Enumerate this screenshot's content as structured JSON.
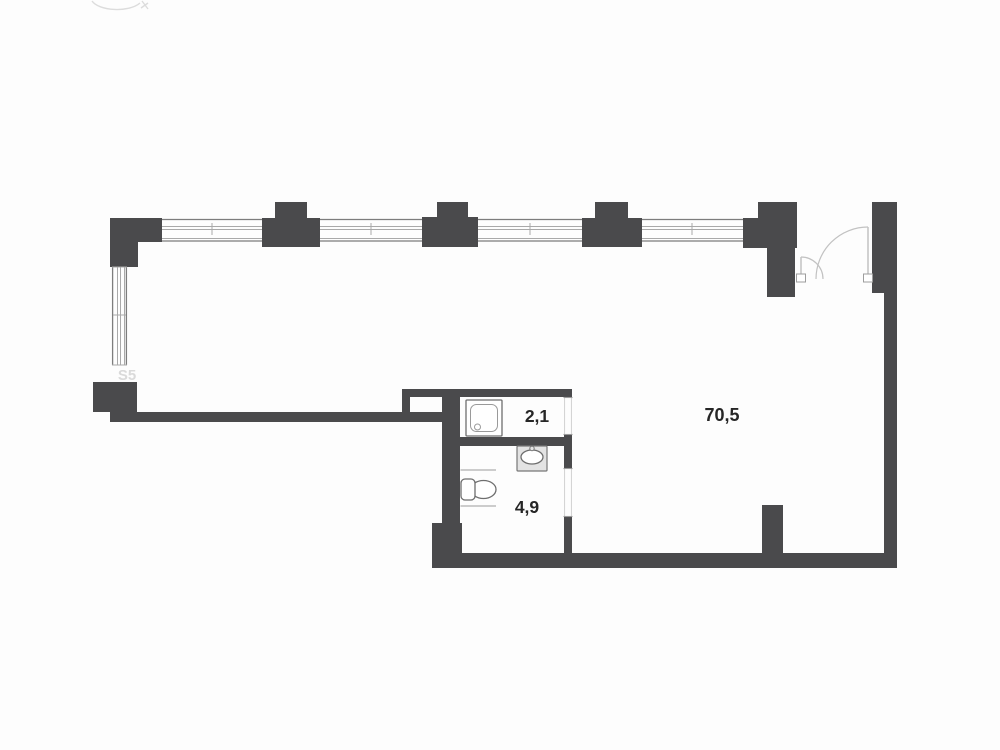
{
  "plan": {
    "title": "apartment-floor-plan",
    "watermark": "S5",
    "rooms": [
      {
        "name": "living-room",
        "area": "70,5"
      },
      {
        "name": "shower-room",
        "area": "2,1"
      },
      {
        "name": "wc-room",
        "area": "4,9"
      }
    ],
    "fixtures": [
      "shower-tray",
      "sink",
      "toilet"
    ],
    "doors": [
      "entrance-double-door",
      "shower-room-opening",
      "wc-room-opening"
    ],
    "windows": [
      "top-window-1",
      "top-window-2",
      "top-window-3",
      "top-window-4",
      "left-window"
    ],
    "colors": {
      "wall": "#4a4a4c",
      "winedge": "#7d7d7d",
      "winline": "#a9a9a9",
      "fixture": "#6e6e6e",
      "door": "#c2c2c2",
      "label": "#262626",
      "watermark": "#dadada",
      "bg": "#fdfdfd"
    }
  }
}
